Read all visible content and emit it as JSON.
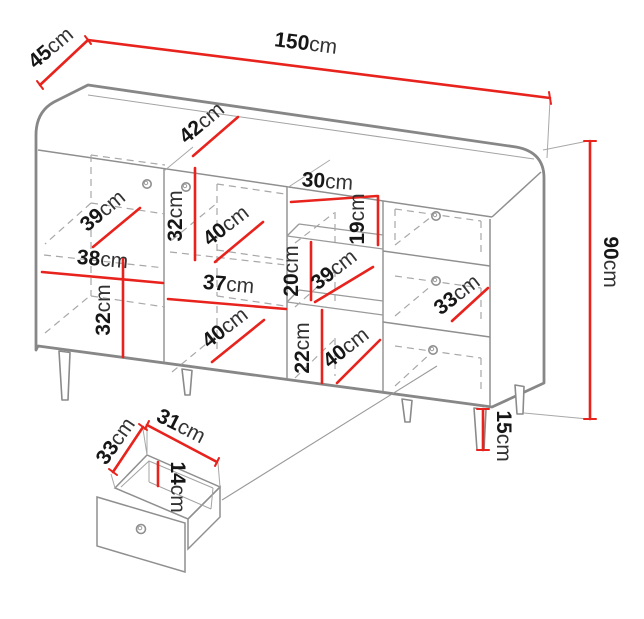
{
  "unit": "cm",
  "colors": {
    "dimension_line": "#e8231d",
    "outline": "#878787",
    "interior_line": "#9a9a9a",
    "hidden_edge_dashed": "#a8a8a8",
    "label_text": "#1b1b1b",
    "background": "#ffffff"
  },
  "dimensions": {
    "overall": {
      "depth": {
        "value": "45",
        "unit": "cm"
      },
      "width": {
        "value": "150",
        "unit": "cm"
      },
      "height": {
        "value": "90",
        "unit": "cm"
      },
      "leg_height": {
        "value": "15",
        "unit": "cm"
      }
    },
    "top_middle_width": {
      "value": "42",
      "unit": "cm"
    },
    "left_door": {
      "shelf_depth": {
        "value": "39",
        "unit": "cm"
      },
      "inner_width": {
        "value": "38",
        "unit": "cm"
      },
      "lower_inner_height": {
        "value": "32",
        "unit": "cm"
      }
    },
    "middle_door": {
      "upper_inner_height": {
        "value": "32",
        "unit": "cm"
      },
      "upper_shelf_depth": {
        "value": "40",
        "unit": "cm"
      },
      "inner_width": {
        "value": "37",
        "unit": "cm"
      },
      "lower_shelf_depth": {
        "value": "40",
        "unit": "cm"
      }
    },
    "open_shelves": {
      "inner_width": {
        "value": "30",
        "unit": "cm"
      },
      "top_inner_height": {
        "value": "19",
        "unit": "cm"
      },
      "middle_inner_height": {
        "value": "20",
        "unit": "cm"
      },
      "middle_shelf_depth": {
        "value": "39",
        "unit": "cm"
      },
      "bottom_inner_height": {
        "value": "22",
        "unit": "cm"
      },
      "bottom_shelf_depth": {
        "value": "40",
        "unit": "cm"
      }
    },
    "drawers": {
      "front_width": {
        "value": "33",
        "unit": "cm"
      }
    },
    "drawer_detail": {
      "depth": {
        "value": "33",
        "unit": "cm"
      },
      "width": {
        "value": "31",
        "unit": "cm"
      },
      "inner_height": {
        "value": "14",
        "unit": "cm"
      }
    }
  }
}
